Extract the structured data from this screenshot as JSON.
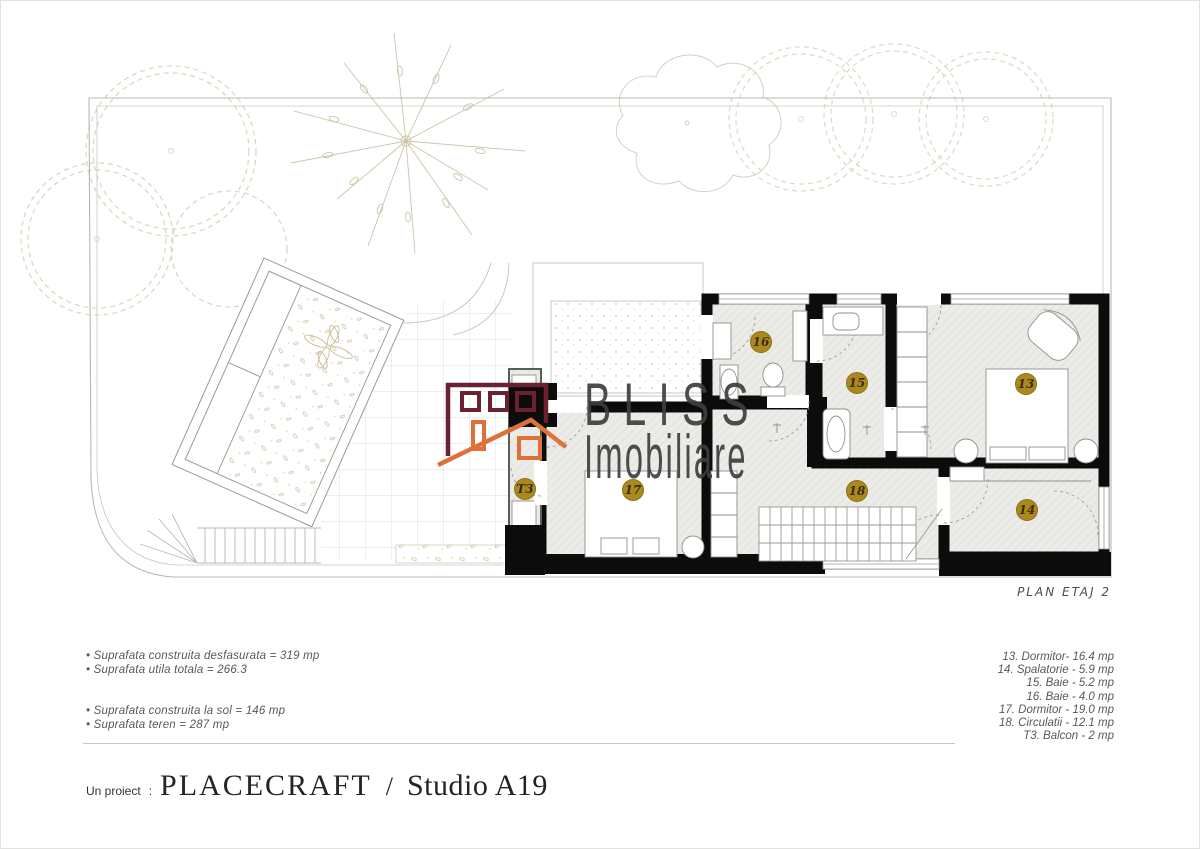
{
  "plan": {
    "label": "PLAN  ETAJ 2",
    "badge_color": "#aa8a1e",
    "badge_text_color": "#3d2a10",
    "badges": [
      {
        "label": "16",
        "x": 760,
        "y": 341
      },
      {
        "label": "15",
        "x": 856,
        "y": 382
      },
      {
        "label": "13",
        "x": 1025,
        "y": 383
      },
      {
        "label": "17",
        "x": 632,
        "y": 489
      },
      {
        "label": "18",
        "x": 856,
        "y": 490
      },
      {
        "label": "14",
        "x": 1026,
        "y": 509
      },
      {
        "label": "T3",
        "x": 524,
        "y": 488
      }
    ]
  },
  "logo": {
    "line1": "BLISS",
    "line2": "Imobiliare",
    "maroon": "#6b2130",
    "orange": "#e0703a",
    "text_color": "#3e3e3e"
  },
  "stats": {
    "group1": [
      "• Suprafata construita desfasurata = 319 mp",
      "• Suprafata utila totala = 266.3"
    ],
    "group2": [
      "• Suprafata construita la sol = 146 mp",
      "• Suprafata teren = 287 mp"
    ]
  },
  "legend": [
    "13. Dormitor- 16.4 mp",
    "14. Spalatorie - 5.9 mp",
    "15. Baie - 5.2 mp",
    "16. Baie - 4.0 mp",
    "17. Dormitor - 19.0 mp",
    "18. Circulatii - 12.1 mp",
    "T3. Balcon - 2 mp"
  ],
  "footer": {
    "prefix": "Un proiect",
    "colon": ":",
    "studio": "PLACECRAFT",
    "slash": "/",
    "name": "Studio A19"
  }
}
